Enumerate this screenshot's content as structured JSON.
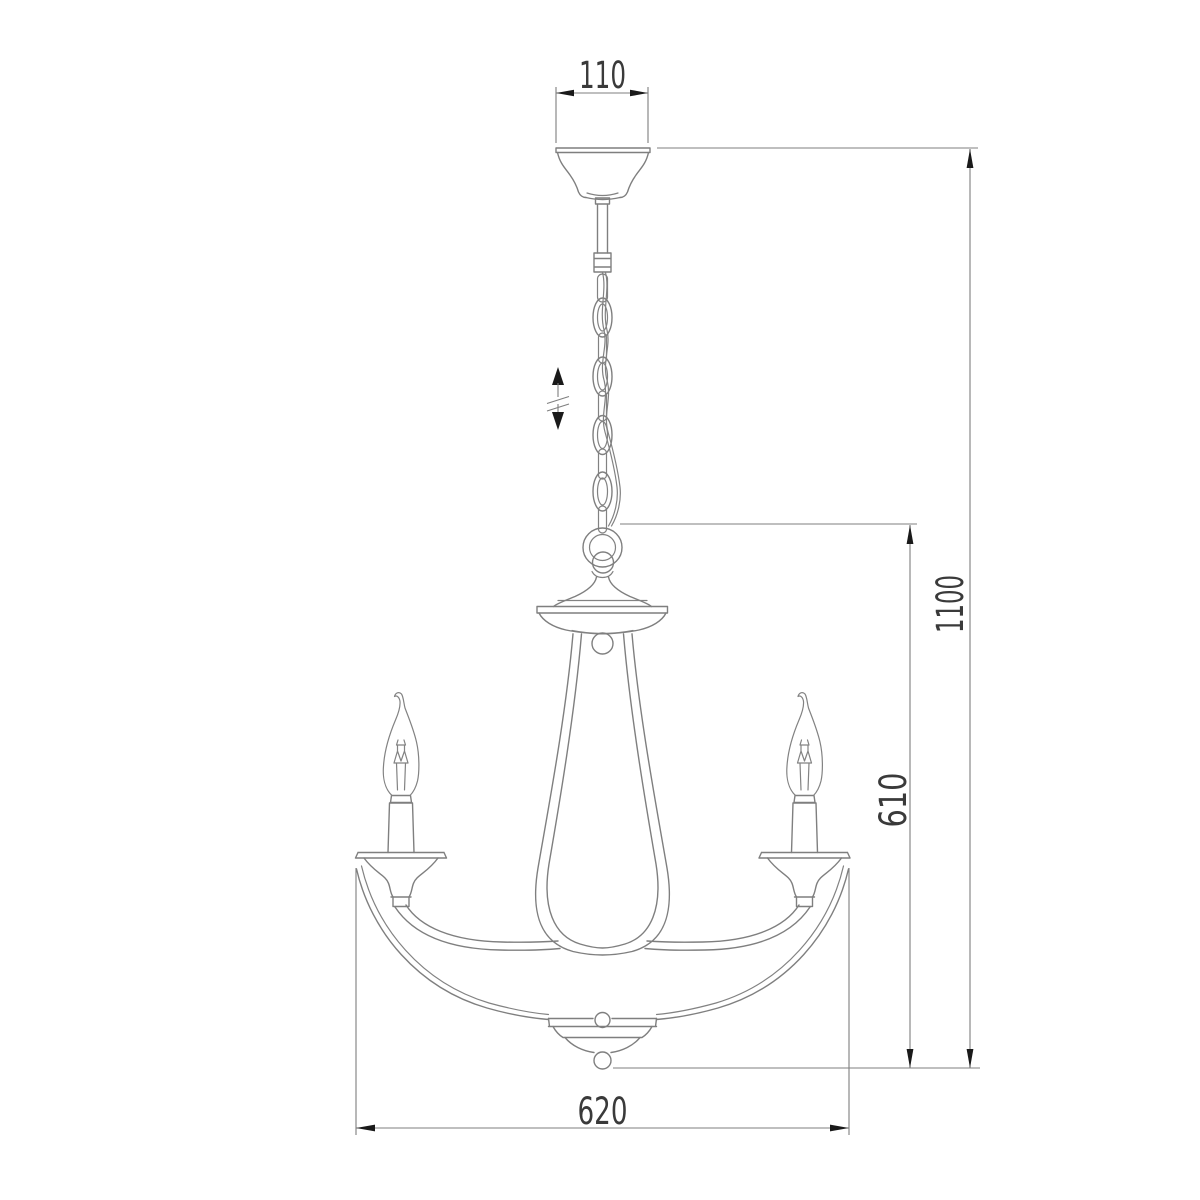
{
  "drawing": {
    "kind": "technical dimension drawing",
    "subject": "three-arm chandelier with candle bulbs, chain suspension and ceiling canopy",
    "background": "#ffffff"
  },
  "dimensions": {
    "canopy_width": "110",
    "overall_height": "1100",
    "body_height": "610",
    "body_width": "620"
  },
  "symbols": {
    "height_adjustment": "double-headed vertical arrow with break marks (adjustable suspension length)"
  },
  "colors": {
    "outline": "#7f7f7f",
    "dimension_line": "#7f7f7f",
    "arrowhead": "#1a1a1a",
    "text": "#3a3a3a"
  }
}
